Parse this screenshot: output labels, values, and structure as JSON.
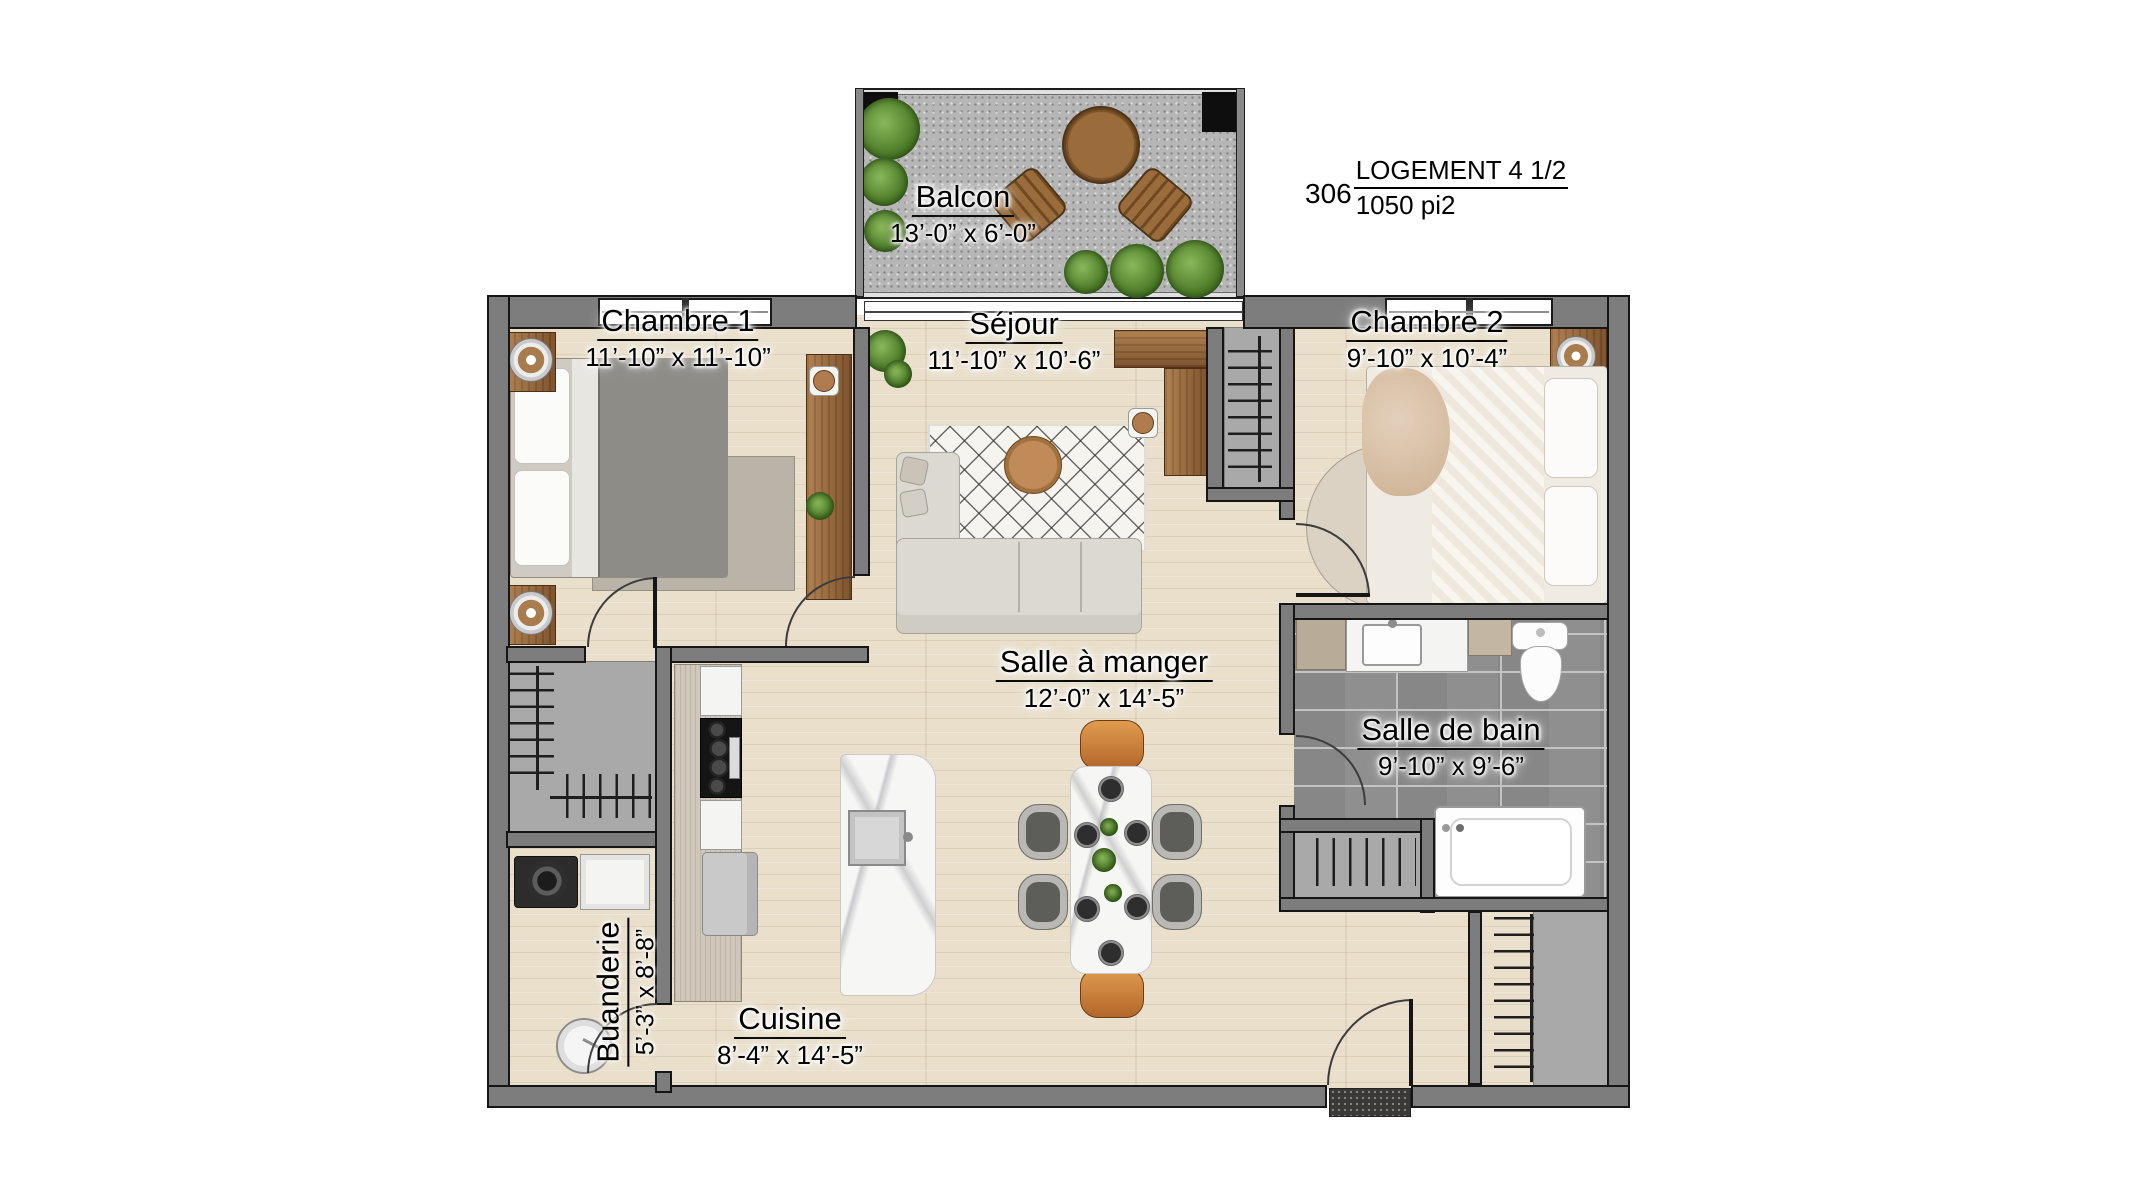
{
  "title_block": {
    "unit_number": "306",
    "unit_type": "LOGEMENT 4 1/2",
    "unit_area": "1050 pi2"
  },
  "rooms": {
    "balcon": {
      "name": "Balcon",
      "dim": "13’-0” x 6’-0”"
    },
    "chambre1": {
      "name": "Chambre 1",
      "dim": "11’-10” x 11’-10”"
    },
    "sejour": {
      "name": "Séjour",
      "dim": "11’-10” x 10’-6”"
    },
    "chambre2": {
      "name": "Chambre 2",
      "dim": "9’-10” x 10’-4”"
    },
    "salle_a_manger": {
      "name": "Salle à manger",
      "dim": "12’-0” x 14’-5”"
    },
    "salle_de_bain": {
      "name": "Salle de bain",
      "dim": "9’-10” x 9’-6”"
    },
    "buanderie": {
      "name": "Buanderie",
      "dim": "5’-3” x 8’-8”"
    },
    "cuisine": {
      "name": "Cuisine",
      "dim": "8’-4” x 14’-5”"
    }
  },
  "colors": {
    "wall": "#7d7d7d",
    "wall_outline": "#151515",
    "wood_floor": "#e9dfcb",
    "bath_tile": "#8f8f8f",
    "closet_floor": "#a9a9a9",
    "balcony_concrete": "#b6b6b6",
    "furniture_wood": "#96663a",
    "accent_chair": "#c77f35"
  }
}
